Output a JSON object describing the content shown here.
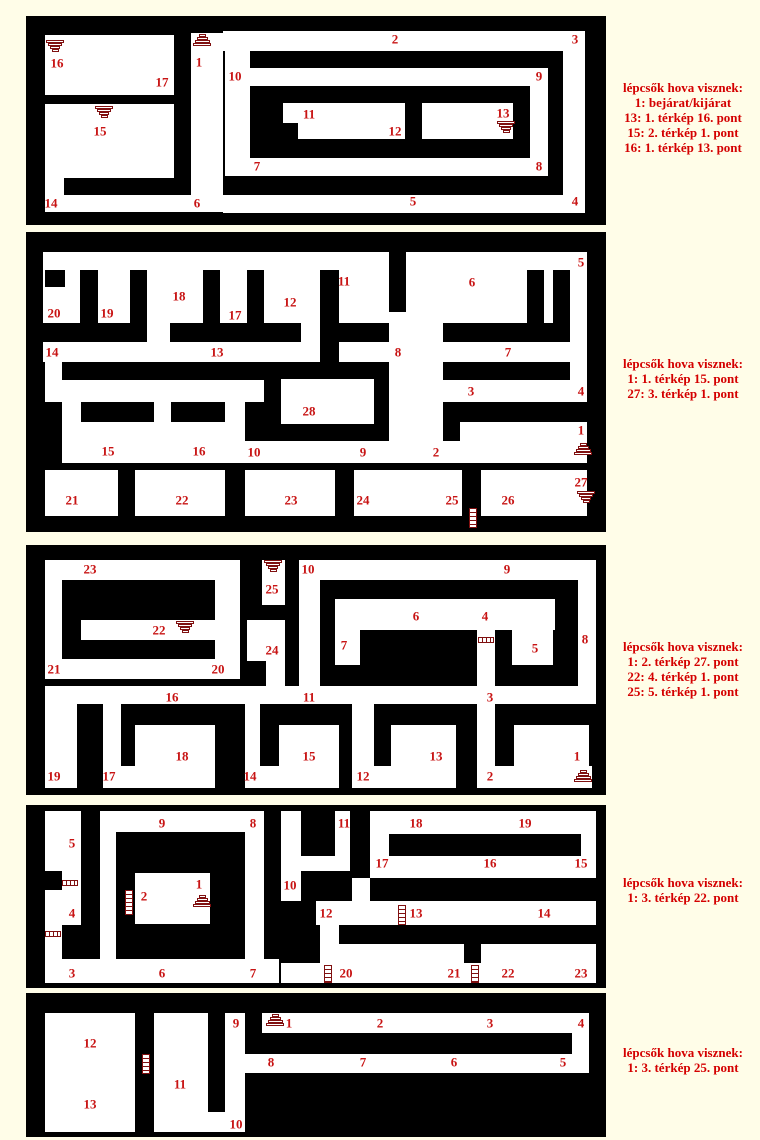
{
  "colors": {
    "page_bg": "#fffde8",
    "panel_bg": "#000000",
    "passage": "#ffffff",
    "label_red": "#c81414",
    "legend_red": "#d40000",
    "icon_maroon": "#801010"
  },
  "legend_blocks": [
    {
      "top": 80,
      "lines": [
        "lépcsők hova visznek:",
        "1: bejárat/kijárat",
        "13: 1. térkép 16. pont",
        "15: 2. térkép 1. pont",
        "16: 1. térkép 13. pont"
      ]
    },
    {
      "top": 356,
      "lines": [
        "lépcsők hova visznek:",
        "1: 1. térkép 15. pont",
        "27: 3. térkép 1. pont"
      ]
    },
    {
      "top": 639,
      "lines": [
        "lépcsők hova visznek:",
        "1: 2. térkép 27. pont",
        "22: 4. térkép 1. pont",
        "25: 5. térkép 1. pont"
      ]
    },
    {
      "top": 875,
      "lines": [
        "lépcsők hova visznek:",
        "1: 3. térkép 22. pont"
      ]
    },
    {
      "top": 1045,
      "lines": [
        "lépcsők hova visznek:",
        "1: 3. térkép 25. pont"
      ]
    }
  ],
  "panels": [
    {
      "name": "map-1",
      "x": 26,
      "y": 16,
      "w": 580,
      "h": 209,
      "whites": [
        [
          19,
          19,
          129,
          60
        ],
        [
          19,
          88,
          129,
          74
        ],
        [
          19,
          162,
          19,
          34
        ],
        [
          19,
          179,
          160,
          17
        ],
        [
          165,
          17,
          32,
          179
        ],
        [
          197,
          15,
          362,
          20
        ],
        [
          537,
          15,
          22,
          182
        ],
        [
          197,
          179,
          362,
          18
        ],
        [
          199,
          35,
          25,
          125
        ],
        [
          224,
          52,
          298,
          18
        ],
        [
          504,
          52,
          18,
          108
        ],
        [
          224,
          142,
          298,
          18
        ],
        [
          257,
          87,
          122,
          20
        ],
        [
          272,
          107,
          107,
          16
        ],
        [
          396,
          87,
          91,
          36
        ]
      ],
      "blacks": [],
      "labels": [
        {
          "t": "16",
          "x": 31,
          "y": 47
        },
        {
          "t": "17",
          "x": 136,
          "y": 66
        },
        {
          "t": "1",
          "x": 173,
          "y": 46
        },
        {
          "t": "15",
          "x": 74,
          "y": 115
        },
        {
          "t": "14",
          "x": 25,
          "y": 187
        },
        {
          "t": "6",
          "x": 171,
          "y": 187
        },
        {
          "t": "2",
          "x": 369,
          "y": 23
        },
        {
          "t": "3",
          "x": 549,
          "y": 23
        },
        {
          "t": "10",
          "x": 209,
          "y": 60
        },
        {
          "t": "9",
          "x": 513,
          "y": 60
        },
        {
          "t": "8",
          "x": 513,
          "y": 150
        },
        {
          "t": "7",
          "x": 231,
          "y": 150
        },
        {
          "t": "11",
          "x": 283,
          "y": 98
        },
        {
          "t": "12",
          "x": 369,
          "y": 115
        },
        {
          "t": "13",
          "x": 477,
          "y": 97
        },
        {
          "t": "5",
          "x": 387,
          "y": 185
        },
        {
          "t": "4",
          "x": 549,
          "y": 185
        }
      ],
      "icons": [
        {
          "k": "sd",
          "x": 20,
          "y": 24
        },
        {
          "k": "su",
          "x": 167,
          "y": 18
        },
        {
          "k": "sd",
          "x": 69,
          "y": 90
        },
        {
          "k": "sd",
          "x": 471,
          "y": 105
        }
      ]
    },
    {
      "name": "map-2",
      "x": 26,
      "y": 232,
      "w": 580,
      "h": 300,
      "whites": [
        [
          17,
          20,
          544,
          71
        ],
        [
          121,
          91,
          23,
          19
        ],
        [
          275,
          91,
          19,
          19
        ],
        [
          363,
          91,
          54,
          140
        ],
        [
          544,
          91,
          17,
          79
        ],
        [
          17,
          110,
          544,
          20
        ],
        [
          19,
          110,
          17,
          60
        ],
        [
          19,
          148,
          219,
          22
        ],
        [
          417,
          148,
          144,
          22
        ],
        [
          36,
          170,
          19,
          20
        ],
        [
          128,
          170,
          17,
          61
        ],
        [
          199,
          170,
          20,
          61
        ],
        [
          36,
          190,
          92,
          41
        ],
        [
          145,
          190,
          54,
          41
        ],
        [
          434,
          190,
          127,
          19
        ],
        [
          219,
          209,
          342,
          22
        ],
        [
          255,
          147,
          93,
          45
        ],
        [
          19,
          238,
          73,
          46
        ],
        [
          109,
          238,
          90,
          46
        ],
        [
          219,
          238,
          90,
          46
        ],
        [
          328,
          238,
          108,
          46
        ],
        [
          455,
          238,
          106,
          46
        ]
      ],
      "blacks": [
        [
          19,
          38,
          20,
          17
        ],
        [
          54,
          38,
          18,
          53
        ],
        [
          104,
          38,
          17,
          53
        ],
        [
          177,
          38,
          17,
          53
        ],
        [
          221,
          38,
          17,
          53
        ],
        [
          294,
          38,
          19,
          92
        ],
        [
          363,
          16,
          17,
          64
        ],
        [
          501,
          38,
          17,
          53
        ],
        [
          527,
          38,
          17,
          72
        ]
      ],
      "labels": [
        {
          "t": "20",
          "x": 28,
          "y": 81
        },
        {
          "t": "19",
          "x": 81,
          "y": 81
        },
        {
          "t": "18",
          "x": 153,
          "y": 64
        },
        {
          "t": "17",
          "x": 209,
          "y": 83
        },
        {
          "t": "12",
          "x": 264,
          "y": 70
        },
        {
          "t": "11",
          "x": 318,
          "y": 49
        },
        {
          "t": "6",
          "x": 446,
          "y": 50
        },
        {
          "t": "5",
          "x": 555,
          "y": 30
        },
        {
          "t": "14",
          "x": 26,
          "y": 120
        },
        {
          "t": "13",
          "x": 191,
          "y": 120
        },
        {
          "t": "8",
          "x": 372,
          "y": 120
        },
        {
          "t": "7",
          "x": 482,
          "y": 120
        },
        {
          "t": "3",
          "x": 445,
          "y": 159
        },
        {
          "t": "4",
          "x": 555,
          "y": 159
        },
        {
          "t": "15",
          "x": 82,
          "y": 219
        },
        {
          "t": "16",
          "x": 173,
          "y": 219
        },
        {
          "t": "10",
          "x": 228,
          "y": 220
        },
        {
          "t": "9",
          "x": 337,
          "y": 220
        },
        {
          "t": "2",
          "x": 410,
          "y": 220
        },
        {
          "t": "1",
          "x": 555,
          "y": 198
        },
        {
          "t": "28",
          "x": 283,
          "y": 179
        },
        {
          "t": "21",
          "x": 46,
          "y": 268
        },
        {
          "t": "22",
          "x": 156,
          "y": 268
        },
        {
          "t": "23",
          "x": 265,
          "y": 268
        },
        {
          "t": "24",
          "x": 337,
          "y": 268
        },
        {
          "t": "25",
          "x": 426,
          "y": 268
        },
        {
          "t": "26",
          "x": 482,
          "y": 268
        },
        {
          "t": "27",
          "x": 555,
          "y": 250
        }
      ],
      "icons": [
        {
          "k": "su",
          "x": 548,
          "y": 211
        },
        {
          "k": "sd",
          "x": 551,
          "y": 259
        },
        {
          "k": "lv",
          "x": 443,
          "y": 276,
          "h": 20
        }
      ]
    },
    {
      "name": "map-3",
      "x": 26,
      "y": 545,
      "w": 580,
      "h": 250,
      "whites": [
        [
          19,
          15,
          195,
          20
        ],
        [
          19,
          35,
          17,
          99
        ],
        [
          189,
          35,
          25,
          99
        ],
        [
          19,
          114,
          195,
          20
        ],
        [
          55,
          75,
          134,
          20
        ],
        [
          236,
          15,
          23,
          45
        ],
        [
          221,
          75,
          38,
          41
        ],
        [
          240,
          116,
          19,
          30
        ],
        [
          273,
          15,
          297,
          20
        ],
        [
          273,
          15,
          21,
          126
        ],
        [
          552,
          15,
          18,
          126
        ],
        [
          309,
          54,
          220,
          31
        ],
        [
          309,
          85,
          25,
          35
        ],
        [
          451,
          85,
          18,
          158
        ],
        [
          486,
          85,
          41,
          35
        ],
        [
          19,
          141,
          551,
          18
        ],
        [
          19,
          159,
          32,
          84
        ],
        [
          77,
          159,
          18,
          84
        ],
        [
          77,
          221,
          112,
          22
        ],
        [
          109,
          180,
          80,
          63
        ],
        [
          219,
          159,
          15,
          84
        ],
        [
          219,
          221,
          94,
          22
        ],
        [
          253,
          180,
          60,
          63
        ],
        [
          326,
          159,
          22,
          84
        ],
        [
          326,
          221,
          104,
          22
        ],
        [
          365,
          180,
          65,
          63
        ],
        [
          451,
          221,
          115,
          22
        ],
        [
          488,
          180,
          75,
          63
        ]
      ],
      "blacks": [],
      "labels": [
        {
          "t": "23",
          "x": 64,
          "y": 24
        },
        {
          "t": "21",
          "x": 28,
          "y": 124
        },
        {
          "t": "20",
          "x": 192,
          "y": 124
        },
        {
          "t": "22",
          "x": 133,
          "y": 85
        },
        {
          "t": "25",
          "x": 246,
          "y": 44
        },
        {
          "t": "24",
          "x": 246,
          "y": 105
        },
        {
          "t": "10",
          "x": 282,
          "y": 24
        },
        {
          "t": "9",
          "x": 481,
          "y": 24
        },
        {
          "t": "6",
          "x": 390,
          "y": 71
        },
        {
          "t": "7",
          "x": 318,
          "y": 100
        },
        {
          "t": "4",
          "x": 459,
          "y": 71
        },
        {
          "t": "5",
          "x": 509,
          "y": 103
        },
        {
          "t": "8",
          "x": 559,
          "y": 94
        },
        {
          "t": "16",
          "x": 146,
          "y": 152
        },
        {
          "t": "11",
          "x": 283,
          "y": 152
        },
        {
          "t": "3",
          "x": 464,
          "y": 152
        },
        {
          "t": "19",
          "x": 28,
          "y": 231
        },
        {
          "t": "17",
          "x": 83,
          "y": 231
        },
        {
          "t": "18",
          "x": 156,
          "y": 211
        },
        {
          "t": "14",
          "x": 224,
          "y": 231
        },
        {
          "t": "15",
          "x": 283,
          "y": 211
        },
        {
          "t": "12",
          "x": 337,
          "y": 231
        },
        {
          "t": "13",
          "x": 410,
          "y": 211
        },
        {
          "t": "2",
          "x": 464,
          "y": 231
        },
        {
          "t": "1",
          "x": 551,
          "y": 211
        }
      ],
      "icons": [
        {
          "k": "sd",
          "x": 238,
          "y": 15
        },
        {
          "k": "sd",
          "x": 150,
          "y": 76
        },
        {
          "k": "lh",
          "x": 452,
          "y": 92
        },
        {
          "k": "su",
          "x": 548,
          "y": 225
        }
      ]
    },
    {
      "name": "map-4",
      "x": 26,
      "y": 805,
      "w": 580,
      "h": 183,
      "whites": [
        [
          19,
          6,
          36,
          148
        ],
        [
          19,
          154,
          234,
          24
        ],
        [
          74,
          6,
          164,
          21
        ],
        [
          74,
          6,
          16,
          148
        ],
        [
          219,
          6,
          19,
          148
        ],
        [
          109,
          68,
          75,
          51
        ],
        [
          255,
          6,
          20,
          90
        ],
        [
          275,
          51,
          49,
          15
        ],
        [
          309,
          6,
          15,
          60
        ],
        [
          344,
          6,
          226,
          67
        ],
        [
          326,
          73,
          18,
          28
        ],
        [
          290,
          96,
          280,
          24
        ],
        [
          294,
          120,
          19,
          43
        ],
        [
          313,
          139,
          125,
          19
        ],
        [
          455,
          139,
          115,
          19
        ],
        [
          255,
          158,
          315,
          20
        ]
      ],
      "blacks": [
        [
          363,
          29,
          192,
          22
        ],
        [
          19,
          66,
          17,
          19
        ],
        [
          36,
          120,
          30,
          34
        ]
      ],
      "labels": [
        {
          "t": "5",
          "x": 46,
          "y": 38
        },
        {
          "t": "4",
          "x": 46,
          "y": 108
        },
        {
          "t": "9",
          "x": 136,
          "y": 18
        },
        {
          "t": "8",
          "x": 227,
          "y": 18
        },
        {
          "t": "11",
          "x": 318,
          "y": 18
        },
        {
          "t": "10",
          "x": 264,
          "y": 80
        },
        {
          "t": "2",
          "x": 118,
          "y": 91
        },
        {
          "t": "1",
          "x": 173,
          "y": 79
        },
        {
          "t": "18",
          "x": 390,
          "y": 18
        },
        {
          "t": "19",
          "x": 499,
          "y": 18
        },
        {
          "t": "17",
          "x": 356,
          "y": 58
        },
        {
          "t": "16",
          "x": 464,
          "y": 58
        },
        {
          "t": "15",
          "x": 555,
          "y": 58
        },
        {
          "t": "12",
          "x": 300,
          "y": 108
        },
        {
          "t": "13",
          "x": 390,
          "y": 108
        },
        {
          "t": "14",
          "x": 518,
          "y": 108
        },
        {
          "t": "3",
          "x": 46,
          "y": 168
        },
        {
          "t": "6",
          "x": 136,
          "y": 168
        },
        {
          "t": "7",
          "x": 227,
          "y": 168
        },
        {
          "t": "20",
          "x": 320,
          "y": 168
        },
        {
          "t": "21",
          "x": 428,
          "y": 168
        },
        {
          "t": "22",
          "x": 482,
          "y": 168
        },
        {
          "t": "23",
          "x": 555,
          "y": 168
        }
      ],
      "icons": [
        {
          "k": "lh",
          "x": 36,
          "y": 75
        },
        {
          "k": "lh",
          "x": 19,
          "y": 126
        },
        {
          "k": "lv",
          "x": 99,
          "y": 85,
          "h": 25
        },
        {
          "k": "su",
          "x": 167,
          "y": 90
        },
        {
          "k": "lv",
          "x": 372,
          "y": 100,
          "h": 20
        },
        {
          "k": "lv",
          "x": 298,
          "y": 160,
          "h": 18
        },
        {
          "k": "lv",
          "x": 445,
          "y": 160,
          "h": 18
        }
      ]
    },
    {
      "name": "map-5",
      "x": 26,
      "y": 993,
      "w": 580,
      "h": 144,
      "whites": [
        [
          19,
          20,
          90,
          119
        ],
        [
          128,
          20,
          54,
          119
        ],
        [
          199,
          20,
          20,
          119
        ],
        [
          182,
          119,
          17,
          20
        ],
        [
          236,
          20,
          327,
          20
        ],
        [
          219,
          61,
          344,
          19
        ],
        [
          546,
          20,
          17,
          60
        ]
      ],
      "blacks": [],
      "labels": [
        {
          "t": "12",
          "x": 64,
          "y": 50
        },
        {
          "t": "13",
          "x": 64,
          "y": 111
        },
        {
          "t": "11",
          "x": 154,
          "y": 91
        },
        {
          "t": "9",
          "x": 210,
          "y": 30
        },
        {
          "t": "10",
          "x": 210,
          "y": 131
        },
        {
          "t": "1",
          "x": 263,
          "y": 30
        },
        {
          "t": "2",
          "x": 354,
          "y": 30
        },
        {
          "t": "3",
          "x": 464,
          "y": 30
        },
        {
          "t": "4",
          "x": 555,
          "y": 30
        },
        {
          "t": "8",
          "x": 245,
          "y": 69
        },
        {
          "t": "7",
          "x": 337,
          "y": 69
        },
        {
          "t": "6",
          "x": 428,
          "y": 69
        },
        {
          "t": "5",
          "x": 537,
          "y": 69
        }
      ],
      "icons": [
        {
          "k": "lv",
          "x": 116,
          "y": 61,
          "h": 20
        },
        {
          "k": "su",
          "x": 240,
          "y": 21
        }
      ]
    }
  ]
}
